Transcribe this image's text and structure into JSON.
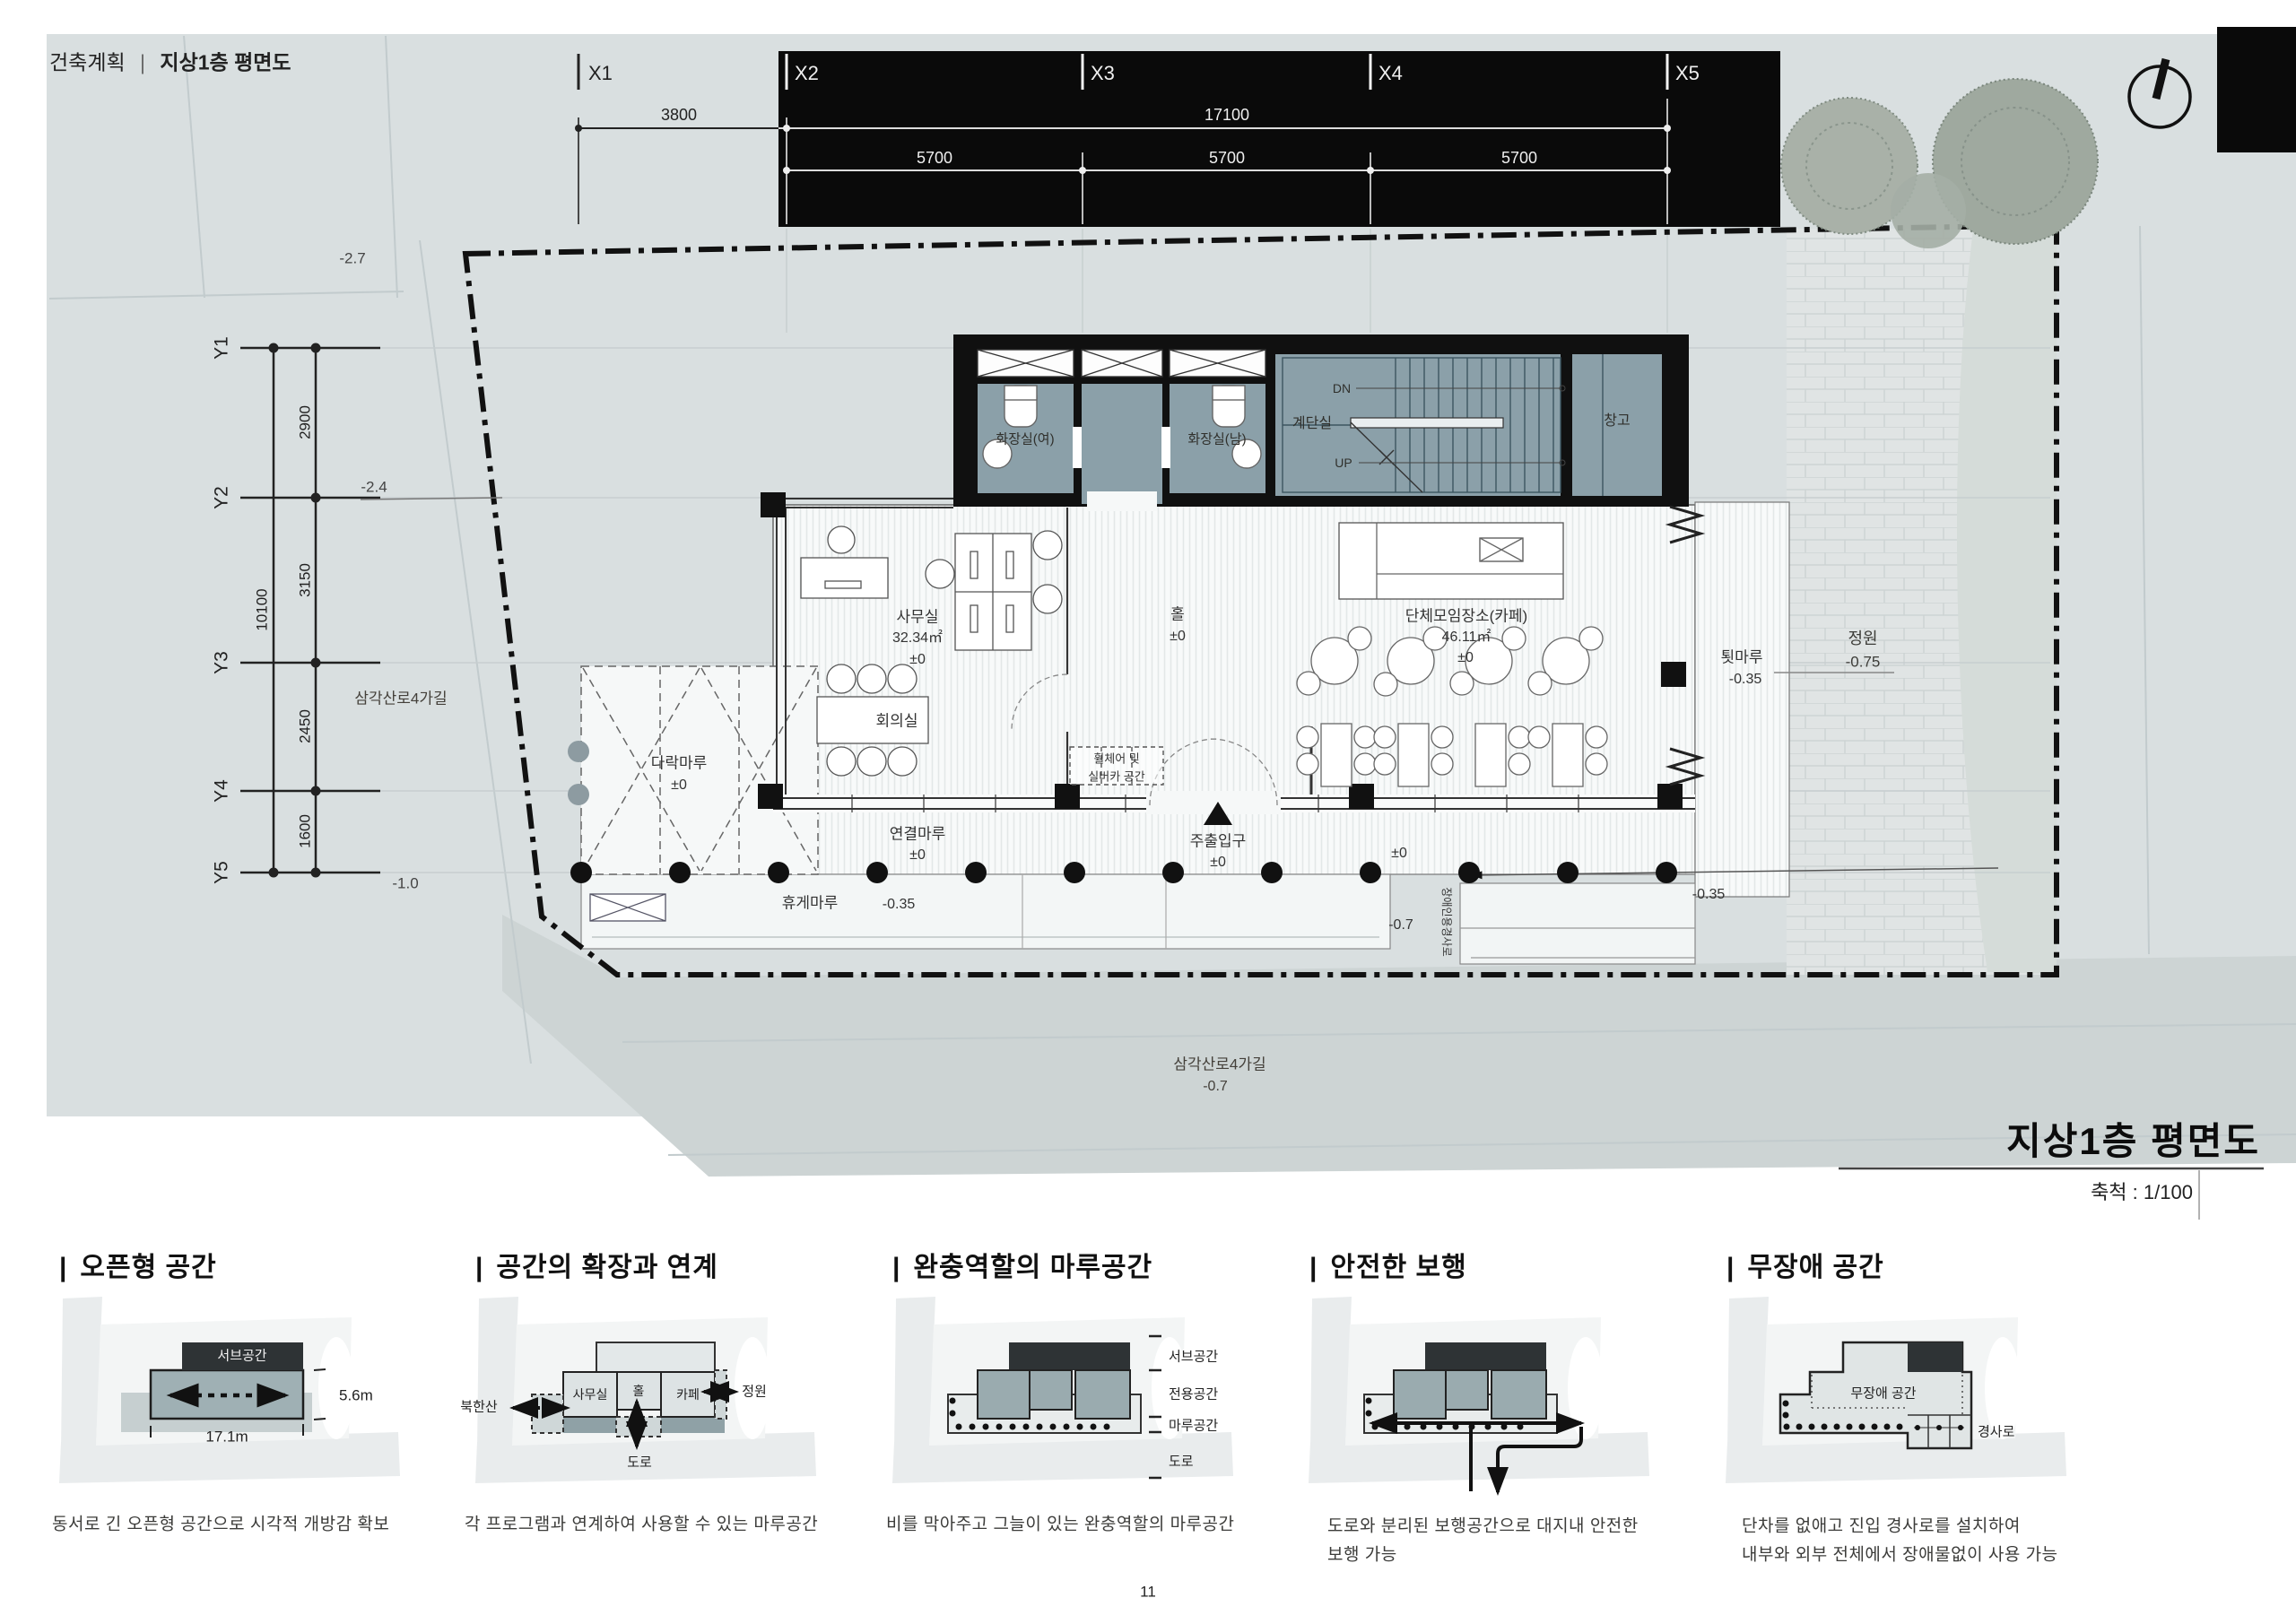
{
  "header": {
    "left": "건축계획",
    "divider": "|",
    "right": "지상1층 평면도"
  },
  "titleblock": {
    "title": "지상1층 평면도",
    "scale": "축척 : 1/100"
  },
  "grid": {
    "x": [
      "X1",
      "X2",
      "X3",
      "X4",
      "X5"
    ],
    "xdim_3800": "3800",
    "xdim_17100": "17100",
    "xdim_5700a": "5700",
    "xdim_5700b": "5700",
    "xdim_5700c": "5700",
    "y": [
      "Y1",
      "Y2",
      "Y3",
      "Y4",
      "Y5"
    ],
    "ydim_total": "10100",
    "ydim_2900": "2900",
    "ydim_3150": "3150",
    "ydim_2450": "2450",
    "ydim_1600": "1600"
  },
  "site": {
    "level_m27": "-2.7",
    "level_m24": "-2.4",
    "level_m10": "-1.0",
    "street_left": "삼각산로4가길",
    "street_bottom": "삼각산로4가길",
    "street_bottom_level": "-0.7",
    "garden": "정원",
    "garden_level": "-0.75"
  },
  "plan": {
    "toilet_w": "화장실(여)",
    "toilet_m": "화장실(남)",
    "stair": "계단실",
    "dn": "DN",
    "up": "UP",
    "storage": "창고",
    "office": "사무실",
    "office_area": "32.34㎡",
    "office_level": "±0",
    "hall": "홀",
    "hall_level": "±0",
    "cafe": "단체모임장소(카페)",
    "cafe_area": "46.11㎡",
    "cafe_level": "±0",
    "meeting": "회의실",
    "attic": "다락마루",
    "attic_level": "±0",
    "connect": "연결마루",
    "connect_level": "±0",
    "rest": "휴게마루",
    "rest_level": "-0.35",
    "toen": "툇마루",
    "toen_level": "-0.35",
    "entrance": "주출입구",
    "entrance_level": "±0",
    "wheelchair1": "휠체어 및",
    "wheelchair2": "실버카 공간",
    "walk_level": "±0",
    "walk_level_right": "-0.35",
    "road_level": "-0.7",
    "ramp_vertical": "장애인용경사로"
  },
  "diagrams_prefix": "|",
  "diagrams": [
    {
      "title": "오픈형 공간",
      "caption1": "동서로 긴 오픈형 공간으로 시각적 개방감 확보",
      "sub": "서브공간",
      "h": "5.6m",
      "w": "17.1m"
    },
    {
      "title": "공간의 확장과 연계",
      "caption1": "각 프로그램과 연계하여 사용할 수 있는 마루공간",
      "mt": "북한산",
      "office": "사무실",
      "hall": "홀",
      "cafe": "카페",
      "garden": "정원",
      "road": "도로"
    },
    {
      "title": "완충역할의 마루공간",
      "caption1": "비를 막아주고 그늘이 있는 완충역할의 마루공간",
      "l1": "서브공간",
      "l2": "전용공간",
      "l3": "마루공간",
      "l4": "도로"
    },
    {
      "title": "안전한 보행",
      "caption1": "도로와 분리된 보행공간으로 대지내 안전한",
      "caption2": "보행 가능"
    },
    {
      "title": "무장애 공간",
      "caption1": "단차를 없애고 진입 경사로를 설치하여",
      "caption2": "내부와 외부 전체에서 장애물없이 사용 가능",
      "inner": "무장애 공간",
      "ramp": "경사로"
    }
  ],
  "footer": {
    "page": "11"
  }
}
